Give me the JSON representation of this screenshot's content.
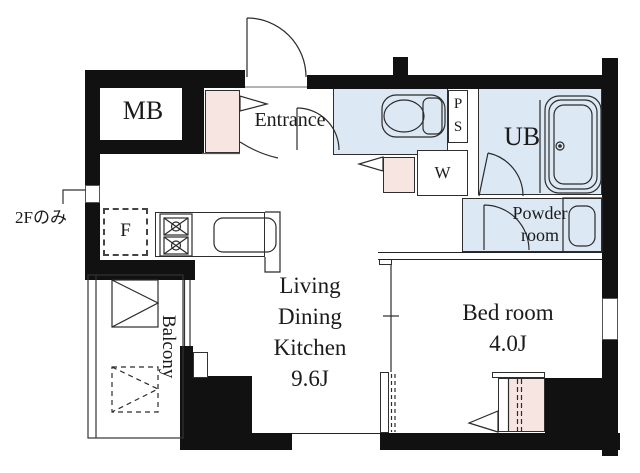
{
  "labels": {
    "mb": "MB",
    "entrance": "Entrance",
    "ps": [
      "P",
      "S"
    ],
    "w": "W",
    "ub": "UB",
    "powder": [
      "Powder",
      "room"
    ],
    "fridge": "F",
    "note": "2Fのみ",
    "balcony": "Balcony",
    "ldk": [
      "Living",
      "Dining",
      "Kitchen",
      "9.6J"
    ],
    "bedroom": [
      "Bed room",
      "4.0J"
    ]
  },
  "colors": {
    "wall": "#111111",
    "wet_area_fill": "#dce8f4",
    "cabinet_fill": "#f7e5e2",
    "linework": "#2b2b2b",
    "background": "#ffffff"
  }
}
